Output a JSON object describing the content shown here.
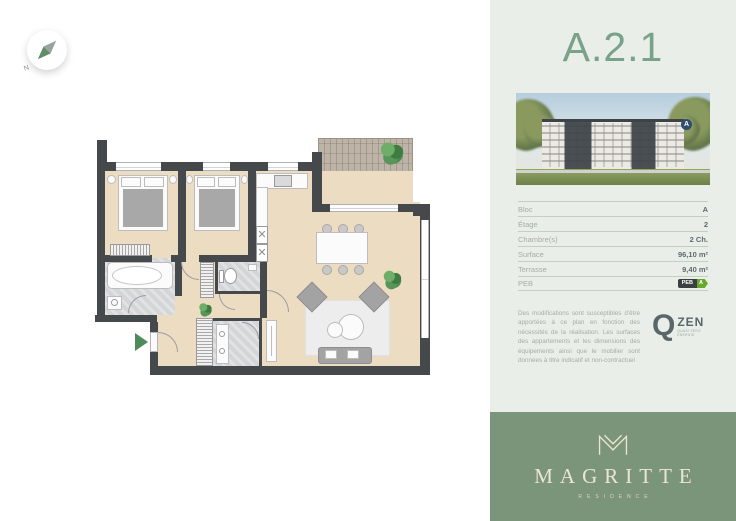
{
  "compass": {
    "label": "N"
  },
  "sidebar": {
    "unit_title": "A.2.1",
    "photo": {
      "badge": "A"
    },
    "specs": [
      {
        "label": "Bloc",
        "value": "A"
      },
      {
        "label": "Étage",
        "value": "2"
      },
      {
        "label": "Chambre(s)",
        "value": "2 Ch."
      },
      {
        "label": "Surface",
        "value": "96,10 m²"
      },
      {
        "label": "Terrasse",
        "value": "9,40 m²"
      },
      {
        "label": "PEB",
        "value": "A",
        "badge": "PEB"
      }
    ],
    "disclaimer": "Des modifications sont susceptibles d'être apportées à ce plan en fonction des nécessités de la réalisation. Les surfaces des appartements et les dimensions des équipements ainsi que le mobilier sont données à titre indicatif et non-contractuel",
    "qzen": {
      "q": "Q",
      "zen": "ZEN",
      "tagline": "QUASI ZERO ENERGIE"
    },
    "brand": {
      "name": "MAGRITTE",
      "subtitle": "RESIDENCE"
    }
  },
  "colors": {
    "accent_green": "#79a389",
    "footer_green": "#7b957a",
    "sidebar_bg": "#e9efe8",
    "wall": "#46494c",
    "floor_wood": "#ecdcc2",
    "tile": "#d4d5d7",
    "deck": "#b5a99b",
    "plant_green": "#4c8a50",
    "entry_arrow_green": "#4f8a5a",
    "peb_badge_green": "#67a82d"
  }
}
